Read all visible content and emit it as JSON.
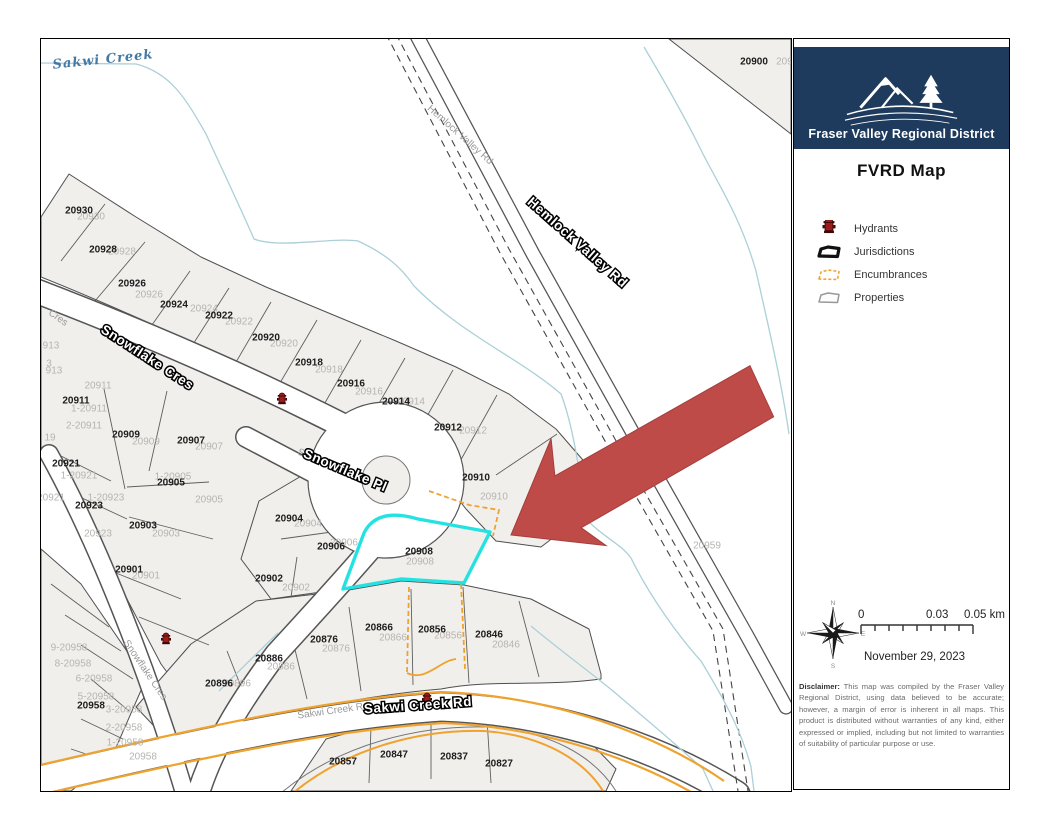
{
  "panel": {
    "brand": "Fraser Valley Regional District",
    "title": "FVRD Map",
    "legend": [
      {
        "label": "Hydrants",
        "icon": "hydrant-icon"
      },
      {
        "label": "Jurisdictions",
        "icon": "jurisdictions-icon"
      },
      {
        "label": "Encumbrances",
        "icon": "encumbrances-icon"
      },
      {
        "label": "Properties",
        "icon": "properties-icon"
      }
    ],
    "compass": {
      "n": "N",
      "e": "E",
      "s": "S",
      "w": "W"
    },
    "scale": {
      "start": "0",
      "mid": "0.03",
      "end": "0.05 km"
    },
    "date": "November 29, 2023",
    "disclaimer_label": "Disclaimer:",
    "disclaimer_text": "This map was compiled by the Fraser Valley Regional District, using data believed to be accurate; however, a margin of error is inherent in all maps. This product is distributed without warranties of any kind, either expressed or implied, including but not limited to warranties of suitability of particular purpose or use."
  },
  "map": {
    "highlighted_parcel": "20908",
    "colors": {
      "highlight": "#25e2e2",
      "encumbrance": "#efa32e",
      "arrow": "#be4b48",
      "creek": "#abd0d8",
      "navy": "#1e3a5c",
      "hydrant": "#9e1b1b"
    },
    "water_labels": [
      {
        "t": "Sakwi Creek",
        "x": 62,
        "y": 21,
        "rot": -6
      }
    ],
    "street_labels_outlined": [
      {
        "t": "Snowflake Cres",
        "x": 106,
        "y": 319,
        "rot": 33
      },
      {
        "t": "Snowflake Pl",
        "x": 304,
        "y": 432,
        "rot": 23
      },
      {
        "t": "Hemlock Valley Rd",
        "x": 536,
        "y": 204,
        "rot": 41.5
      },
      {
        "t": "Sakwi Creek Rd",
        "x": 377,
        "y": 667,
        "rot": -4
      }
    ],
    "street_labels_gray": [
      {
        "t": "Hemlock Valley Rd",
        "x": 419,
        "y": 96,
        "rot": 41.6,
        "s": 9.5
      },
      {
        "t": "Sakwi Creek Rd",
        "x": 292,
        "y": 672,
        "rot": -8,
        "s": 10
      },
      {
        "t": "Snowflake Cres",
        "x": 104,
        "y": 631,
        "rot": 56,
        "s": 10
      },
      {
        "t": "Cres",
        "x": 17,
        "y": 279,
        "rot": 35,
        "s": 10
      },
      {
        "t": "S",
        "x": 260,
        "y": 414,
        "rot": 23,
        "s": 10
      }
    ],
    "parcel_labels": [
      {
        "t": "20930",
        "x": 38,
        "y": 172
      },
      {
        "t": "20928",
        "x": 62,
        "y": 211
      },
      {
        "t": "20926",
        "x": 91,
        "y": 245
      },
      {
        "t": "20924",
        "x": 133,
        "y": 266
      },
      {
        "t": "20922",
        "x": 178,
        "y": 277
      },
      {
        "t": "20920",
        "x": 225,
        "y": 299
      },
      {
        "t": "20918",
        "x": 268,
        "y": 324
      },
      {
        "t": "20916",
        "x": 310,
        "y": 345
      },
      {
        "t": "20914",
        "x": 355,
        "y": 363
      },
      {
        "t": "20912",
        "x": 407,
        "y": 389
      },
      {
        "t": "20910",
        "x": 435,
        "y": 439
      },
      {
        "t": "20911",
        "x": 35,
        "y": 362
      },
      {
        "t": "20909",
        "x": 85,
        "y": 396
      },
      {
        "t": "20907",
        "x": 150,
        "y": 402
      },
      {
        "t": "20921",
        "x": 25,
        "y": 425
      },
      {
        "t": "20905",
        "x": 130,
        "y": 444
      },
      {
        "t": "20923",
        "x": 48,
        "y": 467
      },
      {
        "t": "20903",
        "x": 102,
        "y": 487
      },
      {
        "t": "20904",
        "x": 248,
        "y": 480
      },
      {
        "t": "20906",
        "x": 290,
        "y": 508
      },
      {
        "t": "20902",
        "x": 228,
        "y": 540
      },
      {
        "t": "20908",
        "x": 378,
        "y": 513
      },
      {
        "t": "20901",
        "x": 88,
        "y": 531
      },
      {
        "t": "20896",
        "x": 178,
        "y": 645
      },
      {
        "t": "20886",
        "x": 228,
        "y": 620
      },
      {
        "t": "20876",
        "x": 283,
        "y": 601
      },
      {
        "t": "20866",
        "x": 338,
        "y": 589
      },
      {
        "t": "20856",
        "x": 391,
        "y": 591
      },
      {
        "t": "20846",
        "x": 448,
        "y": 596
      },
      {
        "t": "20958",
        "x": 50,
        "y": 667
      },
      {
        "t": "20857",
        "x": 302,
        "y": 723
      },
      {
        "t": "20847",
        "x": 353,
        "y": 716
      },
      {
        "t": "20837",
        "x": 413,
        "y": 718
      },
      {
        "t": "20827",
        "x": 458,
        "y": 725
      },
      {
        "t": "20900",
        "x": 713,
        "y": 23
      }
    ],
    "parcel_sublabels": [
      {
        "t": "20930",
        "x": 50,
        "y": 178
      },
      {
        "t": "20928",
        "x": 81,
        "y": 213
      },
      {
        "t": "20926",
        "x": 108,
        "y": 256
      },
      {
        "t": "20924",
        "x": 163,
        "y": 270
      },
      {
        "t": "20922",
        "x": 198,
        "y": 283
      },
      {
        "t": "20920",
        "x": 243,
        "y": 305
      },
      {
        "t": "20918",
        "x": 288,
        "y": 331
      },
      {
        "t": "20916",
        "x": 328,
        "y": 353
      },
      {
        "t": "20914",
        "x": 370,
        "y": 363
      },
      {
        "t": "20912",
        "x": 432,
        "y": 392
      },
      {
        "t": "20910",
        "x": 453,
        "y": 458
      },
      {
        "t": "20911",
        "x": 57,
        "y": 347
      },
      {
        "t": "1-20911",
        "x": 48,
        "y": 370
      },
      {
        "t": "2-20911",
        "x": 43,
        "y": 387
      },
      {
        "t": "20909",
        "x": 105,
        "y": 403
      },
      {
        "t": "20907",
        "x": 168,
        "y": 408
      },
      {
        "t": "1-20905",
        "x": 132,
        "y": 438
      },
      {
        "t": "20905",
        "x": 168,
        "y": 461
      },
      {
        "t": "1-20921",
        "x": 38,
        "y": 437
      },
      {
        "t": "20921",
        "x": 10,
        "y": 459
      },
      {
        "t": "1-20923",
        "x": 65,
        "y": 459
      },
      {
        "t": "20923",
        "x": 57,
        "y": 495
      },
      {
        "t": "20903",
        "x": 125,
        "y": 495
      },
      {
        "t": "20901",
        "x": 105,
        "y": 537
      },
      {
        "t": "20904",
        "x": 267,
        "y": 485
      },
      {
        "t": "20906",
        "x": 303,
        "y": 504
      },
      {
        "t": "20902",
        "x": 255,
        "y": 549
      },
      {
        "t": "20908",
        "x": 379,
        "y": 523
      },
      {
        "t": "20866",
        "x": 352,
        "y": 599
      },
      {
        "t": "20856",
        "x": 407,
        "y": 597
      },
      {
        "t": "20846",
        "x": 465,
        "y": 606
      },
      {
        "t": "20876",
        "x": 295,
        "y": 610
      },
      {
        "t": "20886",
        "x": 240,
        "y": 628
      },
      {
        "t": "20896",
        "x": 196,
        "y": 645
      },
      {
        "t": "9-20958",
        "x": 28,
        "y": 609
      },
      {
        "t": "8-20958",
        "x": 32,
        "y": 625
      },
      {
        "t": "6-20958",
        "x": 53,
        "y": 640
      },
      {
        "t": "5-20958",
        "x": 55,
        "y": 658
      },
      {
        "t": "3-20958",
        "x": 83,
        "y": 671
      },
      {
        "t": "2-20958",
        "x": 83,
        "y": 689
      },
      {
        "t": "1-20958",
        "x": 84,
        "y": 704
      },
      {
        "t": "20958",
        "x": 102,
        "y": 718
      },
      {
        "t": "20959",
        "x": 666,
        "y": 507
      },
      {
        "t": "20950",
        "x": 749,
        "y": 23
      },
      {
        "t": "913",
        "x": 10,
        "y": 307
      },
      {
        "t": "3",
        "x": 8,
        "y": 325
      },
      {
        "t": "913",
        "x": 13,
        "y": 332
      },
      {
        "t": "19",
        "x": 9,
        "y": 399
      }
    ],
    "hydrants": [
      {
        "x": 241,
        "y": 359
      },
      {
        "x": 125,
        "y": 599
      },
      {
        "x": 386,
        "y": 659
      }
    ]
  }
}
